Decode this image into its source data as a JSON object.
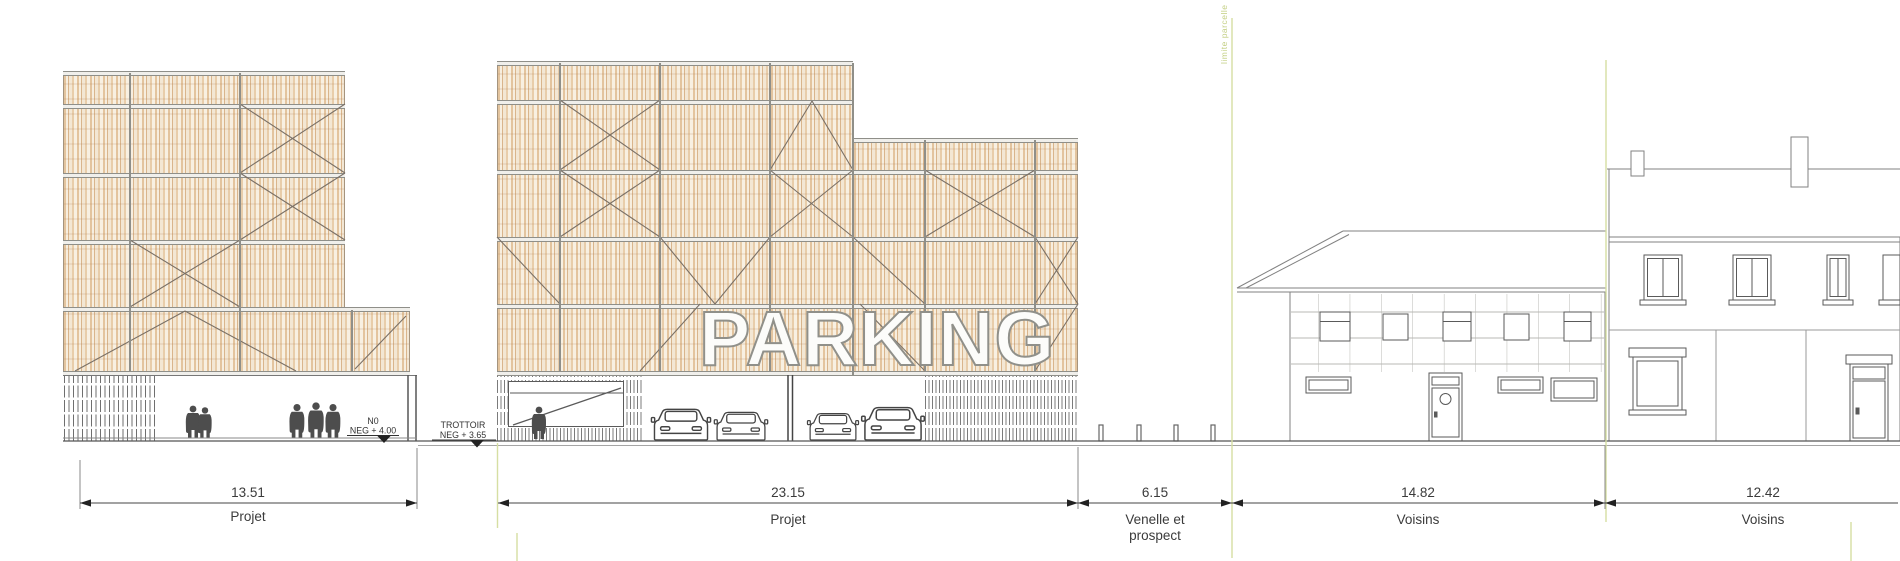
{
  "drawing": {
    "sign": "PARKING",
    "levels": {
      "n0": {
        "line1": "N0",
        "line2": "NEG + 4.00"
      },
      "trottoir": {
        "line1": "TROTTOIR",
        "line2": "NEG + 3.65"
      }
    },
    "parcel_limit_label": "limite parcelle",
    "dimensions": [
      {
        "value": "13.51",
        "label1": "Projet",
        "label2": ""
      },
      {
        "value": "23.15",
        "label1": "Projet",
        "label2": ""
      },
      {
        "value": "6.15",
        "label1": "Venelle et",
        "label2": "prospect"
      },
      {
        "value": "14.82",
        "label1": "Voisins",
        "label2": ""
      },
      {
        "value": "12.42",
        "label1": "Voisins",
        "label2": ""
      }
    ],
    "colors": {
      "wood_light": "#f5ead9",
      "wood_dark": "#d9b58c",
      "band_gray": "#8f8f89",
      "line_gray": "#555555",
      "parcel_green": "#d6dfa3",
      "parcel_text_green": "#c3cf83",
      "dim_text": "#3b3b3b",
      "sign_fill": "#fcfcfa"
    }
  }
}
